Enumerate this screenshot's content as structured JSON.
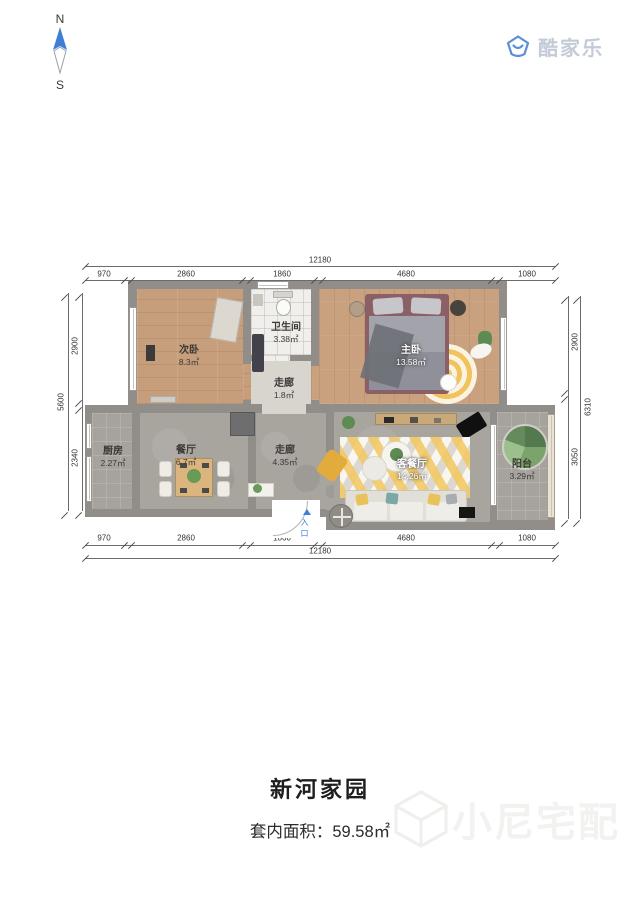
{
  "compass": {
    "north": "N",
    "south": "S"
  },
  "brand": {
    "name": "酷家乐"
  },
  "rooms": {
    "secondary_bedroom": {
      "name": "次卧",
      "area": "8.3㎡"
    },
    "bathroom": {
      "name": "卫生间",
      "area": "3.38㎡"
    },
    "hall_small": {
      "name": "走廊",
      "area": "1.8㎡"
    },
    "master_bedroom": {
      "name": "主卧",
      "area": "13.58㎡"
    },
    "kitchen": {
      "name": "厨房",
      "area": "2.27㎡"
    },
    "dining": {
      "name": "餐厅",
      "area": "6.7㎡"
    },
    "hall": {
      "name": "走廊",
      "area": "4.35㎡"
    },
    "living": {
      "name": "客餐厅",
      "area": "14.26㎡"
    },
    "balcony": {
      "name": "阳台",
      "area": "3.29㎡"
    }
  },
  "entry": {
    "label": "入口"
  },
  "dims": {
    "top": {
      "total": "12180",
      "segments": [
        "970",
        "2860",
        "1860",
        "4680",
        "1080"
      ]
    },
    "bottom": {
      "total": "12180",
      "segments": [
        "970",
        "2860",
        "1860",
        "4680",
        "1080"
      ]
    },
    "left": {
      "total": "5600",
      "segments": [
        "2900",
        "2340"
      ]
    },
    "right": {
      "total": "6310",
      "segments": [
        "2900",
        "3050"
      ]
    }
  },
  "footer": {
    "title": "新河家园",
    "area_label": "套内面积：",
    "area_value": "59.58㎡"
  },
  "watermark": {
    "text": "小尼宅配"
  },
  "colors": {
    "accent_blue": "#3f7fd6",
    "brand_gray": "#c3cbd7",
    "wall_gray": "#918e8a",
    "wood_floor": "#c79e7b",
    "rug_yellow": "#f2c35c"
  }
}
